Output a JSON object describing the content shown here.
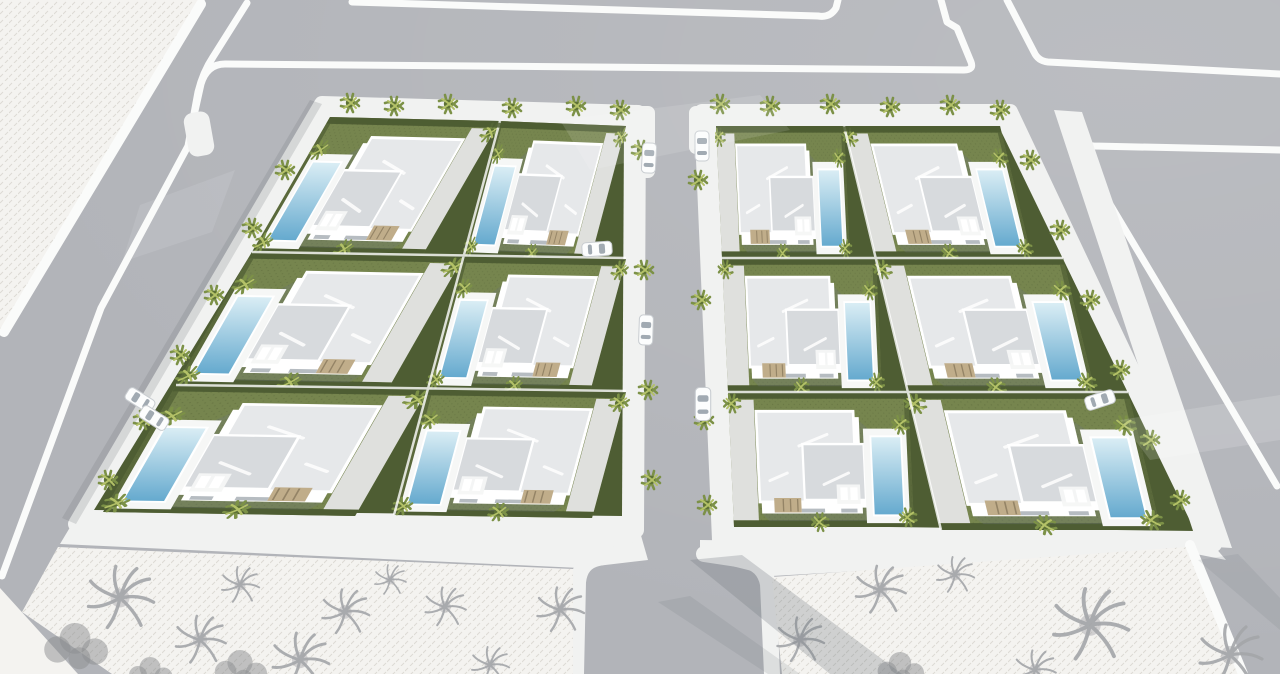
{
  "scene": {
    "title": "Aerial 3D render of a residential villa development",
    "blocks": 2,
    "villas_per_block": 6,
    "total_villas": 12,
    "pools_visible": 12,
    "empty_plots": 3,
    "roads": "grid of gray streets with white curbs framing the two blocks",
    "vegetation": "small palm trees around each villa; sketchy gray trees on unbuilt plots"
  },
  "colors": {
    "road": "#b2b4b9",
    "curb": "#fafbfa",
    "walk": "#f1f2f1",
    "plot": "#f4f3f0",
    "plotTex": "#dcdad4",
    "sketch": "#a3a5a8",
    "sketchDark": "#8b8d90",
    "grass": "#76854e",
    "grassDot": "#46532c",
    "hedge": "#4e5d33",
    "drive": "#dfe0dd",
    "roof1": "#e6e8ea",
    "roof2": "#d7dadd",
    "wall": "#ffffff",
    "deck": "#f6f7f6",
    "pool1": "#dbeef5",
    "pool2": "#64a9ce",
    "palm1": "#7c9147",
    "palm2": "#5d7136",
    "palmLight": "#b3c167",
    "car": "#fcfdfd",
    "tan": "#c0ad8a",
    "shadow": "#70757c"
  }
}
